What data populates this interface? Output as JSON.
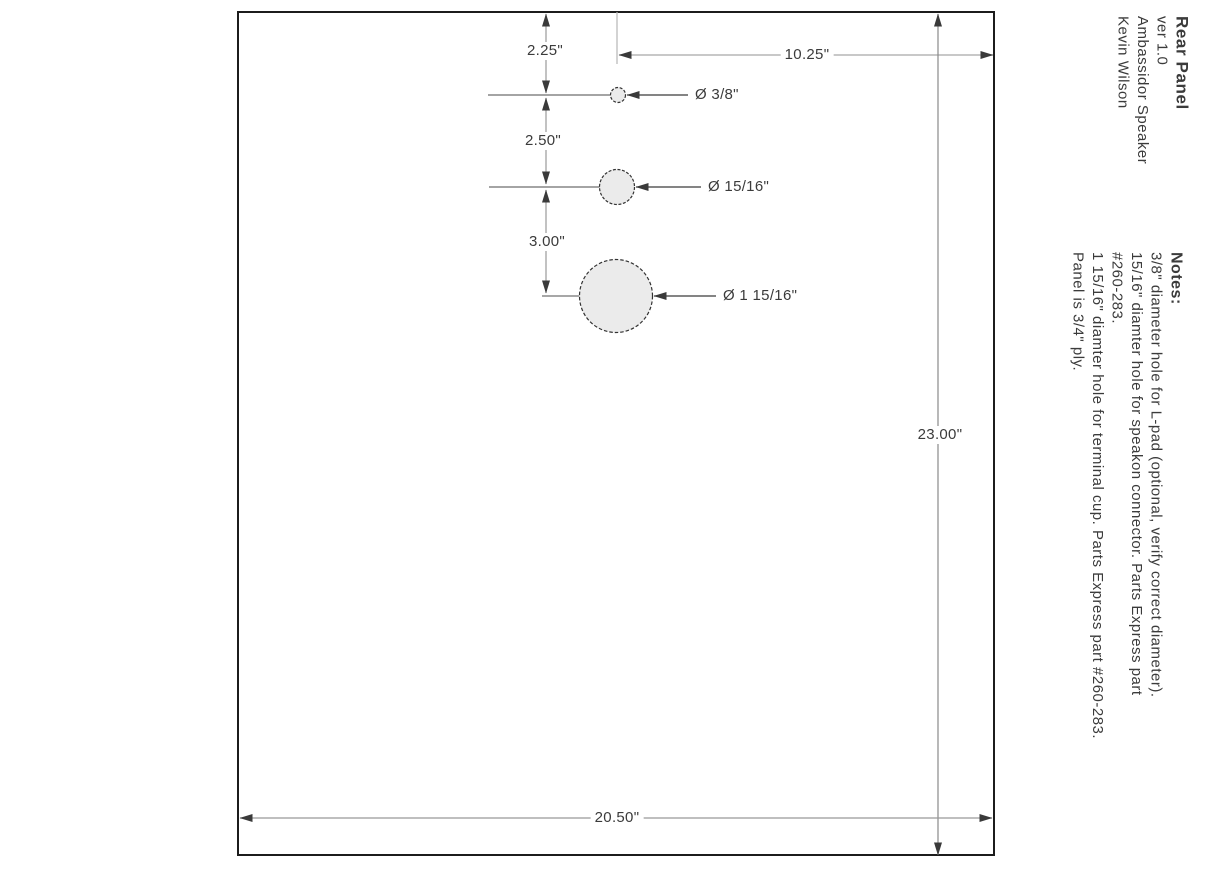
{
  "title_block": {
    "title": "Rear Panel",
    "version": "ver 1.0",
    "project": "Ambassidor Speaker",
    "author": "Kevin Wilson"
  },
  "notes": {
    "heading": "Notes:",
    "lines": [
      "3/8\" diameter hole for L-pad (optional, verify correct diameter).",
      "15/16\" diamter hole for speakon connector. Parts Express part",
      "#260-283.",
      "1 15/16\" diamter hole for terminal cup. Parts Express part #260-283.",
      "Panel is 3/4\" ply."
    ]
  },
  "dimensions": {
    "top_edge_to_hole1": "2.25\"",
    "hole1_to_hole2": "2.50\"",
    "hole2_to_hole3": "3.00\"",
    "hole1_to_right_edge": "10.25\"",
    "panel_height": "23.00\"",
    "panel_width": "20.50\""
  },
  "holes": {
    "hole1_label": "Ø 3/8\"",
    "hole2_label": "Ø 15/16\"",
    "hole3_label": "Ø 1  15/16\""
  },
  "colors": {
    "panel_border": "#1c1c1c",
    "dim_line": "#999999",
    "light_dim_line": "#b5b5b5",
    "arrow": "#3a3a3a",
    "hole_fill": "#ebebeb",
    "hole_stroke": "#333333",
    "text": "#3b3b3b"
  }
}
